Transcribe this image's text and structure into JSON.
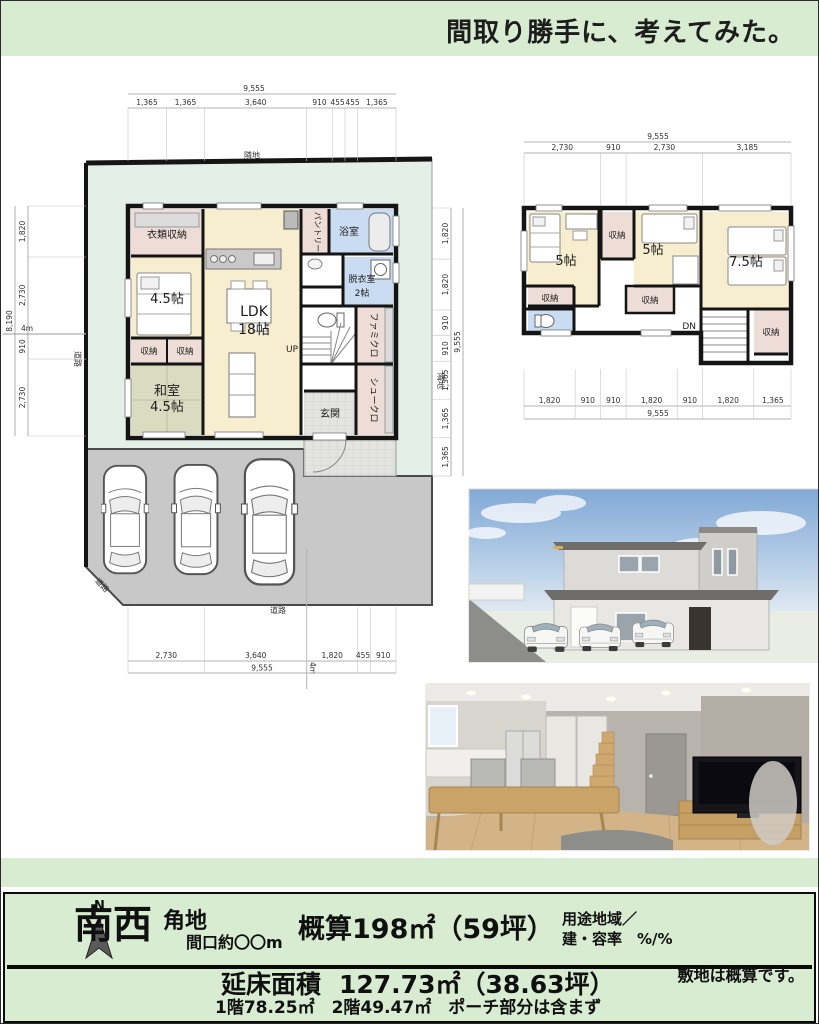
{
  "banner_top": {
    "text": "間取り勝手に、考えてみた。"
  },
  "site": {
    "labels": {
      "neighbor_top": "隣地",
      "neighbor_right": "隣地",
      "road_left": "道路",
      "road_bottom": "道路",
      "road_corner": "道路",
      "road_width_left": "4m",
      "road_width_bottom": "4m"
    }
  },
  "floor1": {
    "rooms": {
      "clothes_storage": "衣類収納",
      "bedroom": "4.5帖",
      "closet_a": "収納",
      "closet_b": "収納",
      "japanese_room_line1": "和室",
      "japanese_room_line2": "4.5帖",
      "ldk_line1": "LDK",
      "ldk_line2": "18帖",
      "pantry": "パントリー",
      "bath": "浴室",
      "dressing_line1": "脱衣室",
      "dressing_line2": "2帖",
      "family_closet": "ファミクロ",
      "shoe_closet": "シュークロ",
      "entrance": "玄関",
      "stairs_up": "UP"
    },
    "dims_top": {
      "total": "9,555",
      "segments": [
        "1,365",
        "1,365",
        "3,640",
        "910",
        "455",
        "455",
        "1,365"
      ]
    },
    "dims_left": {
      "total": "8,190",
      "segments": [
        "1,820",
        "2,730",
        "910",
        "2,730"
      ]
    },
    "dims_right": {
      "total": "9,555",
      "segments": [
        "1,820",
        "1,820",
        "910",
        "910",
        "1,365",
        "1,365",
        "1,365"
      ]
    },
    "dims_bottom": {
      "total": "9,555",
      "segments": [
        "2,730",
        "3,640",
        "1,820",
        "455",
        "910"
      ]
    }
  },
  "floor2": {
    "rooms": {
      "bedroom_left": "5帖",
      "closet_top": "収納",
      "bedroom_mid": "5帖",
      "bedroom_right": "7.5帖",
      "closet_left": "収納",
      "closet_mid": "収納",
      "closet_right": "収納",
      "stairs_down": "DN"
    },
    "dims_top": {
      "total": "9,555",
      "segments": [
        "2,730",
        "910",
        "2,730",
        "3,185"
      ]
    },
    "dims_bottom": {
      "total": "9,555",
      "segments": [
        "1,820",
        "910",
        "910",
        "1,820",
        "910",
        "1,820",
        "1,365"
      ]
    }
  },
  "banner_bottom": {
    "north": "N",
    "direction": "南西",
    "corner": "角地",
    "frontage": "間口約〇〇m",
    "site_area": "概算198㎡（59坪）",
    "zoning_line1": "用途地域／",
    "zoning_line2": "建・容率　%/%",
    "floor_area_label": "延床面積",
    "floor_area_value": "127.73㎡（38.63坪）",
    "floor_breakdown": "1階78.25㎡　2階49.47㎡　ポーチ部分は含まず",
    "site_note": "敷地は概算です。"
  }
}
